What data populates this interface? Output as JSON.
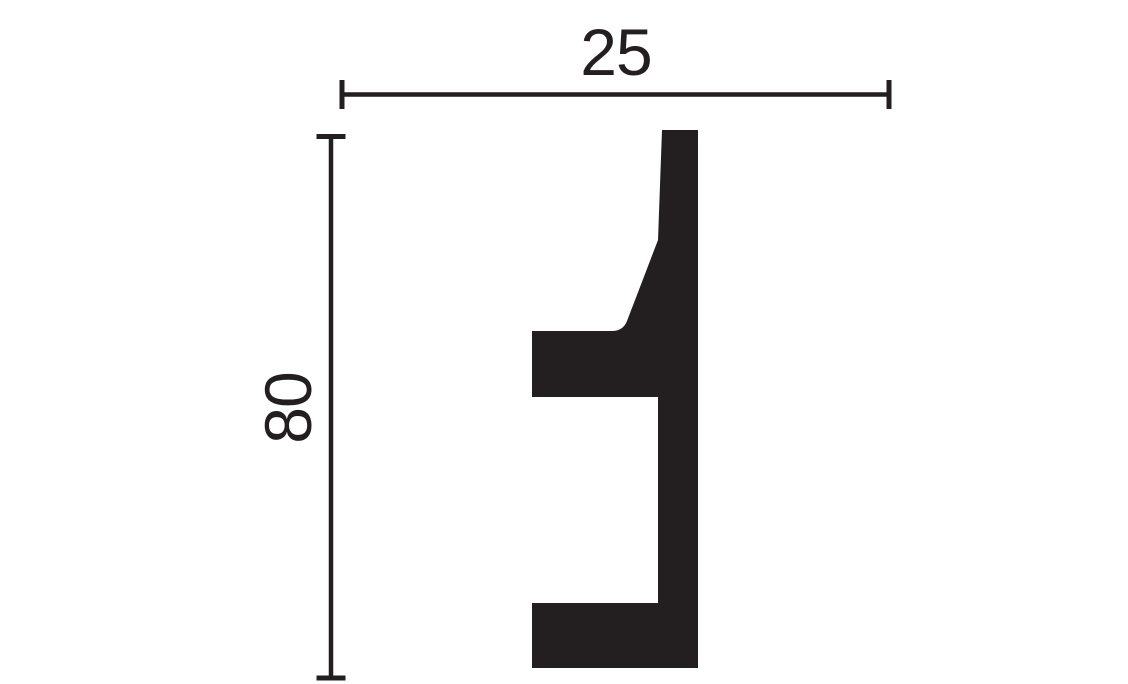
{
  "diagram": {
    "kind": "technical-profile-drawing",
    "subject": "molding-profile-cross-section",
    "background_color": "#ffffff",
    "ink_color": "#231f20",
    "profile": {
      "name": "profile-silhouette",
      "fill": "#231f20",
      "path": "M 662 130 L 698 130 L 698 668 L 532 668 L 532 603 L 658 603 L 658 397 L 532 397 L 532 331 L 612 331 Q 623 331 627 321 L 658 240 Z"
    },
    "dimensions": {
      "width": {
        "label": "25",
        "value": 25,
        "orientation": "horizontal"
      },
      "height": {
        "label": "80",
        "value": 80,
        "orientation": "vertical"
      }
    }
  }
}
